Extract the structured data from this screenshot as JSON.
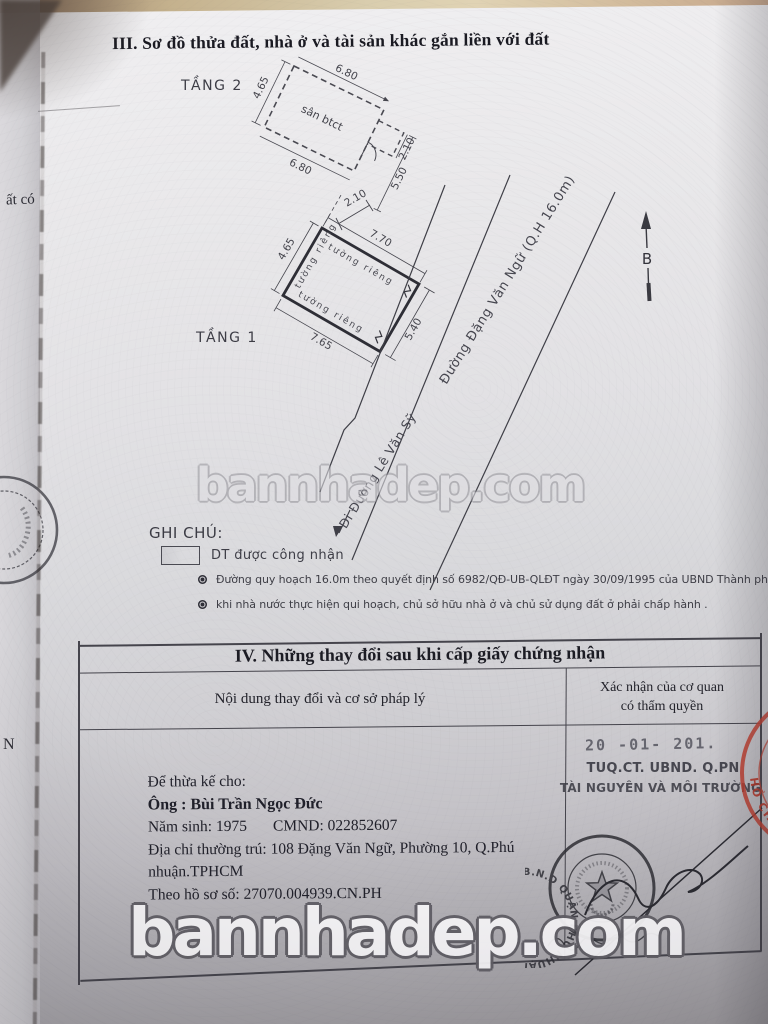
{
  "brand": {
    "watermark": "bannhadep.com"
  },
  "page": {
    "section3_title": "III. Sơ đồ thửa đất, nhà ở và tài sản khác gắn liền với đất",
    "margin_fragment_left": "ất có",
    "margin_fragment_left2": "N"
  },
  "plan": {
    "floor2": {
      "label": "TẦNG 2",
      "area_label": "sân btct",
      "dim_left": "4.65",
      "dim_top": "6.80",
      "dim_right_ext": "2.10",
      "dim_right": "5.50",
      "dim_bottom": "6.80"
    },
    "floor1": {
      "label": "TẦNG 1",
      "dim_left": "4.65",
      "dim_top": "7.70",
      "dim_right": "5.40",
      "dim_bottom": "7.65",
      "dim_gap": "2.10",
      "wall_top": "tường riêng",
      "wall_left": "tường riêng",
      "wall_bottom": "tường riêng"
    },
    "roads": {
      "main": "Đường Đặng Văn Ngữ (Q.H 16.0m)",
      "secondary": "Đi Đường Lê Văn Sỹ"
    },
    "north_label": "B"
  },
  "legend": {
    "title": "GHI CHÚ:",
    "swatch_label": "DT được công nhận",
    "bullets": [
      "Đường quy hoạch 16.0m theo quyết định số 6982/QĐ-UB-QLĐT ngày 30/09/1995 của UBND Thành phố Hồ Chí Minh.",
      "khi nhà nước thực hiện qui hoạch, chủ sở hữu nhà ở và chủ sử dụng đất ở phải chấp hành ."
    ]
  },
  "section4": {
    "title": "IV. Những thay đổi sau khi cấp giấy chứng nhận",
    "col_content": "Nội dung thay đổi và cơ sở pháp lý",
    "col_confirm_line1": "Xác nhận của cơ quan",
    "col_confirm_line2": "có thẩm quyền",
    "entry": {
      "intro": "Để thừa kế cho:",
      "name": "Ông :  Bùi Trần Ngọc Đức",
      "birth": "Năm sinh: 1975",
      "id_number": "CMND: 022852607",
      "address_line1": "Địa chỉ thường trú: 108 Đặng Văn Ngữ, Phường 10, Q.Phú",
      "address_line2": "nhuận.TPHCM",
      "dossier": "Theo hồ sơ số:  27070.004939.CN.PH"
    },
    "approval": {
      "date_stamp": "20 -01- 201.",
      "authority_line1": "TUQ.CT. UBND. Q.PN",
      "authority_line2": "TÀI NGUYÊN VÀ MÔI TRƯỜNG",
      "seal_ring_text": "QUẬN PHÚ NHUẬN ★ HỒ CHÍ MINH ★ U.B.N.D ",
      "red_stamp_text": "HỒ CHÍ MINH"
    }
  }
}
